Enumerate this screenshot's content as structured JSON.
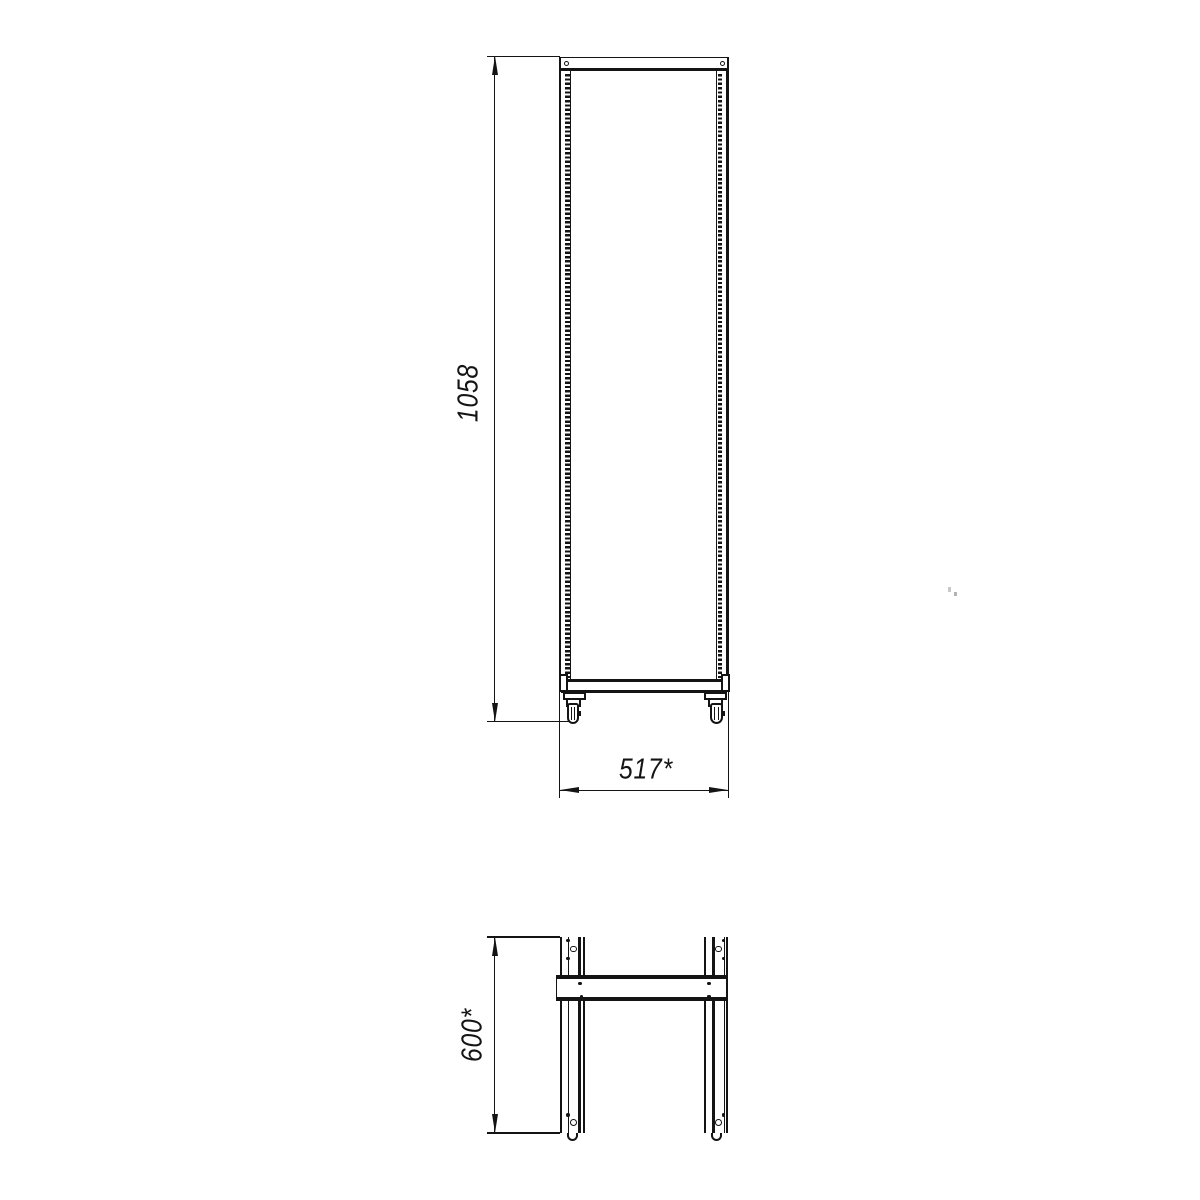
{
  "views": {
    "front": {
      "name": "rack-frame-front-view",
      "dimensions": [
        {
          "label": "1058",
          "axis": "height",
          "orientation": "vertical"
        },
        {
          "label": "517*",
          "axis": "width",
          "orientation": "horizontal"
        }
      ]
    },
    "top": {
      "name": "rack-frame-top-view",
      "dimensions": [
        {
          "label": "600*",
          "axis": "depth",
          "orientation": "vertical"
        }
      ]
    }
  },
  "style": {
    "line_color": "#141414",
    "background": "#ffffff"
  }
}
